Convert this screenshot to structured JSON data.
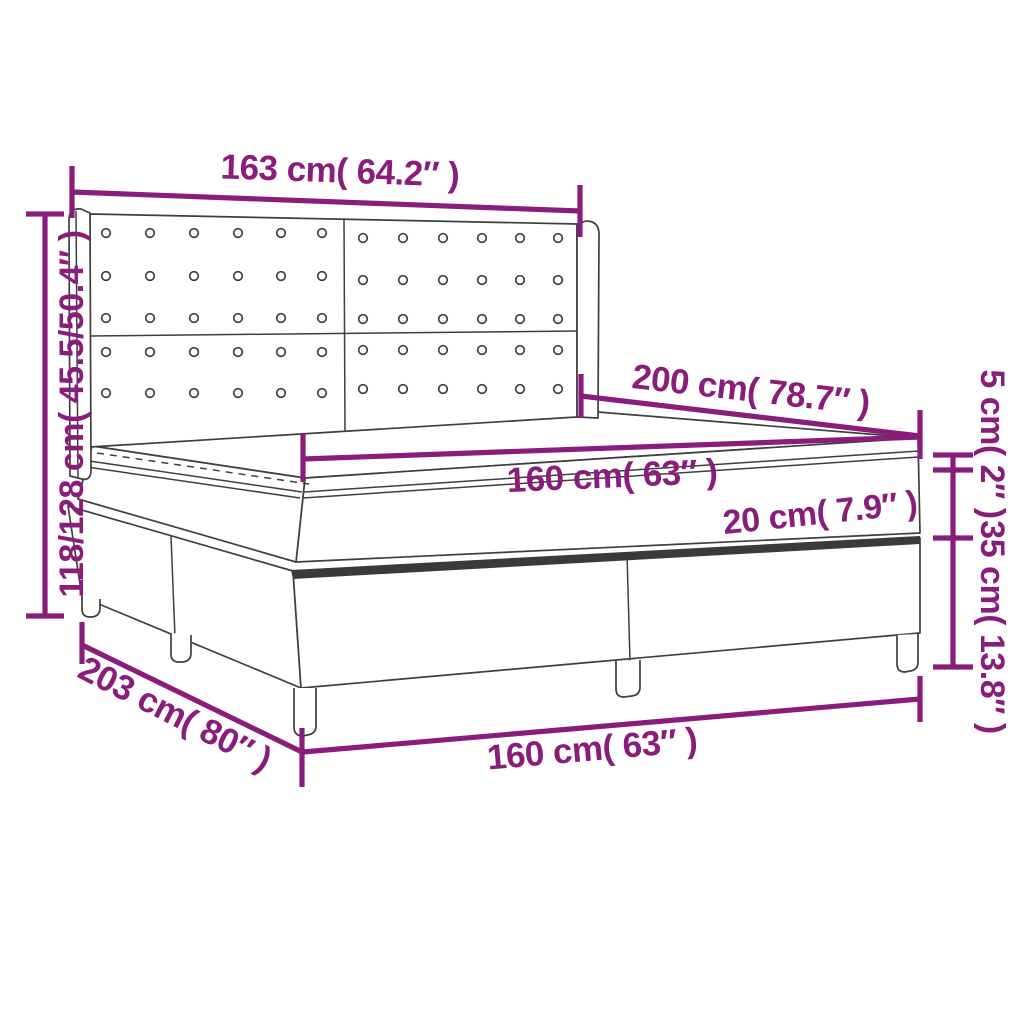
{
  "diagram": {
    "type": "product-dimension-diagram",
    "subject": "box spring bed with tufted wing headboard, pillow-top mattress and legs",
    "colors": {
      "accent": "#8a1c7c",
      "line_art": "#3f3f3f",
      "background": "#ffffff"
    },
    "dimensions": {
      "headboard_width": "163 cm( 64.2″ )",
      "total_height": "118/128 cm( 45.5/50.4″ )",
      "length_top": "200 cm( 78.7″ )",
      "mattress_width": "160 cm( 63″ )",
      "mattress_thickness": "20 cm( 7.9″ )",
      "topper_thickness": "5 cm( 2″ )",
      "base_height": "35 cm( 13.8″ )",
      "length_bottom": "203 cm( 80″ )",
      "base_width": "160 cm( 63″ )"
    }
  }
}
